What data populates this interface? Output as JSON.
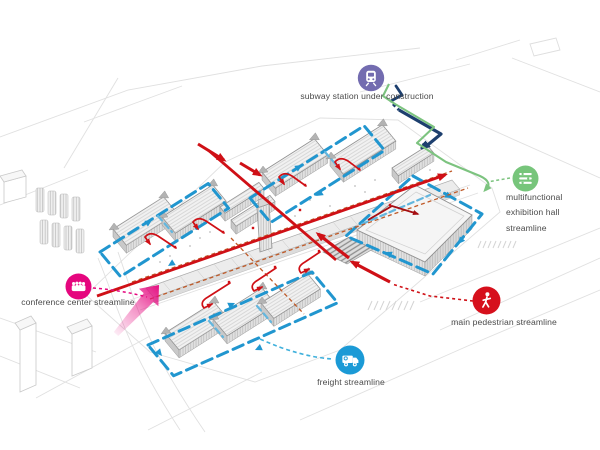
{
  "legend": {
    "subway": {
      "label": "subway station under construction",
      "icon": "train-icon",
      "color": "#736cb0",
      "line_style": "solid navy with short dash break"
    },
    "multifunctional_exhibition_hall": {
      "label": "multifunctional exhibition hall streamline",
      "icon": "exhibition-hall-icon",
      "color": "#77c57b",
      "line_style": "green solid with dashed connector"
    },
    "conference_center": {
      "label": "conference center streamline",
      "icon": "conference-people-icon",
      "color": "#e5067e",
      "line_style": "magenta dashed with gradient arrow"
    },
    "main_pedestrian": {
      "label": "main pedestrian streamline",
      "icon": "walking-person-icon",
      "color": "#d6101c",
      "line_style": "red solid and dashed"
    },
    "freight": {
      "label": "freight streamline",
      "icon": "truck-icon",
      "color": "#1b9ad6",
      "line_style": "blue dashed loops around halls"
    }
  },
  "streamline_colors": {
    "freight_loop": "#2196cf",
    "pedestrian": "#cf1016",
    "pedestrian_dark": "#a50e12",
    "service_dashed_orange": "#bf5a28",
    "subway_navy": "#1d3f6e",
    "exhibition_green": "#7cc37f",
    "conference_magenta": "#e5067e",
    "freight_connector_cyan": "#3fb0dc"
  },
  "drawing": {
    "type": "axonometric site streamline diagram",
    "building_stroke": "#8f8f8f",
    "context_stroke": "#dedede"
  }
}
